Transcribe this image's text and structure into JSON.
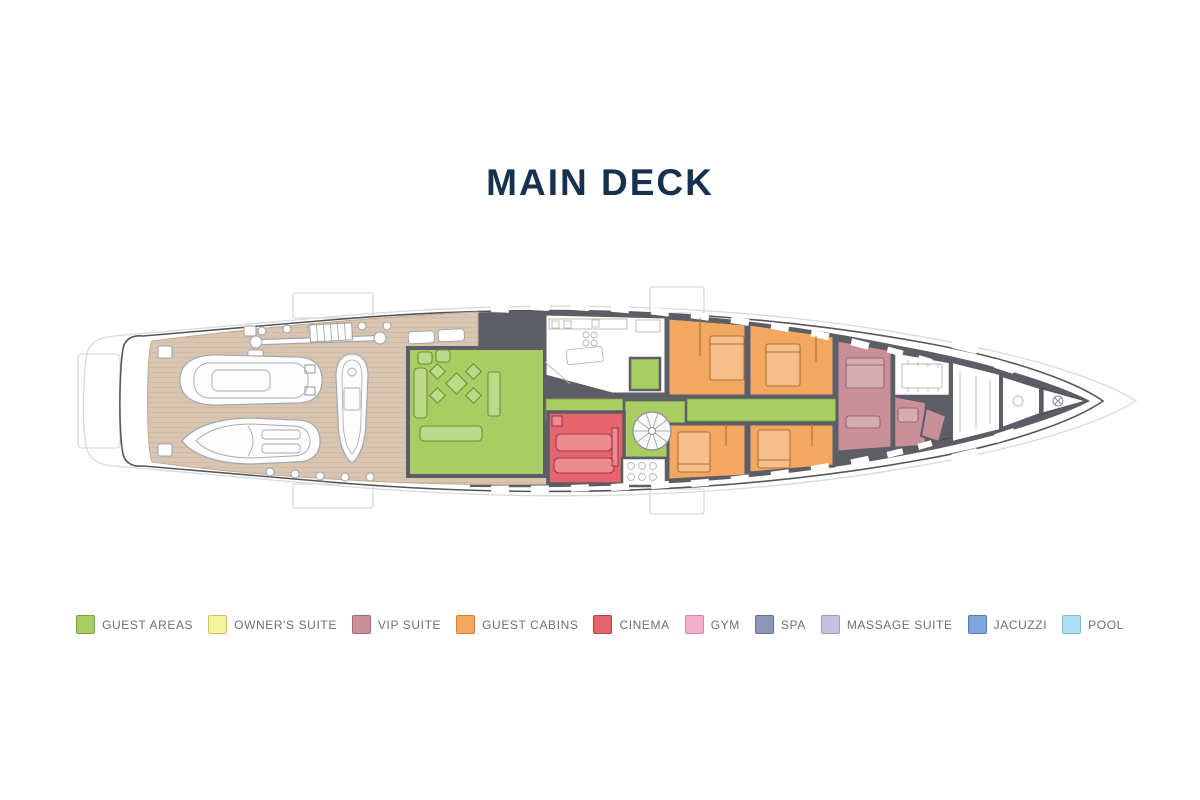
{
  "title": "MAIN DECK",
  "colors": {
    "title_text": "#17324e",
    "page_bg": "#ffffff",
    "hull_fill": "#ffffff",
    "hull_stroke": "#55565c",
    "outline_faint": "#d9d9d9",
    "walls": "#5d5d66",
    "walls_dark_line": "#45454c",
    "deck": "#d8c6b2",
    "deck_line": "#c3ab91",
    "white_room": "#ffffff",
    "legend_text": "#6f6f6f",
    "guest_areas": "#a7cd63",
    "guest_areas_border": "#79a23c",
    "owners_suite": "#f5f2a0",
    "owners_suite_border": "#cfc15d",
    "vip_suite": "#c9909a",
    "vip_suite_border": "#a56b77",
    "guest_cabins": "#f3a862",
    "guest_cabins_border": "#cc7f35",
    "cinema": "#e6646d",
    "cinema_border": "#bf3c47",
    "gym": "#f5b0c9",
    "gym_border": "#d488a5",
    "spa": "#8e96b6",
    "spa_border": "#666f94",
    "massage_suite": "#c6c1e0",
    "massage_suite_border": "#9f97c4",
    "jacuzzi": "#7fa5db",
    "jacuzzi_border": "#5579b3",
    "pool": "#aedff2",
    "pool_border": "#7fbcd9",
    "furniture_green": "#6d8f39",
    "furniture_orange": "#b06f2f",
    "furniture_red": "#a53842",
    "furniture_mauve": "#9a6570",
    "tender_stroke": "#a3a8af",
    "fitting_stroke": "#9aa0a6"
  },
  "legend": {
    "items": [
      {
        "key": "guest_areas",
        "label": "GUEST AREAS",
        "color": "#a7cd63",
        "border": "#79a23c"
      },
      {
        "key": "owners_suite",
        "label": "OWNER'S SUITE",
        "color": "#f5f2a0",
        "border": "#cfc15d"
      },
      {
        "key": "vip_suite",
        "label": "VIP SUITE",
        "color": "#c9909a",
        "border": "#a56b77"
      },
      {
        "key": "guest_cabins",
        "label": "GUEST CABINS",
        "color": "#f3a862",
        "border": "#cc7f35"
      },
      {
        "key": "cinema",
        "label": "CINEMA",
        "color": "#e6646d",
        "border": "#bf3c47"
      },
      {
        "key": "gym",
        "label": "GYM",
        "color": "#f5b0c9",
        "border": "#d488a5"
      },
      {
        "key": "spa",
        "label": "SPA",
        "color": "#8e96b6",
        "border": "#666f94"
      },
      {
        "key": "massage_suite",
        "label": "MASSAGE SUITE",
        "color": "#c6c1e0",
        "border": "#9f97c4"
      },
      {
        "key": "jacuzzi",
        "label": "JACUZZI",
        "color": "#7fa5db",
        "border": "#5579b3"
      },
      {
        "key": "pool",
        "label": "POOL",
        "color": "#aedff2",
        "border": "#7fbcd9"
      }
    ]
  }
}
